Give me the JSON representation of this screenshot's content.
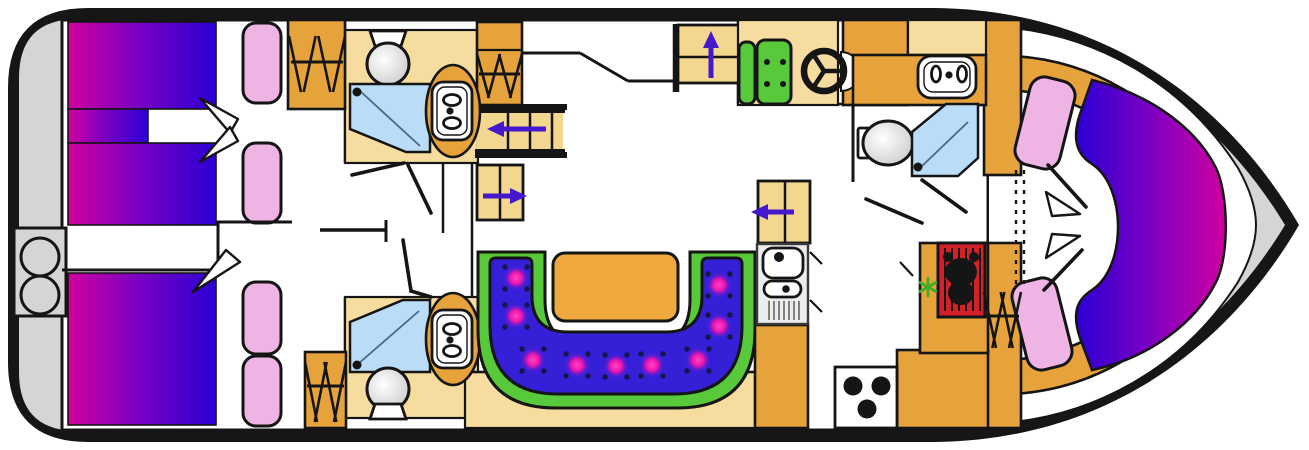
{
  "meta": {
    "title": "Motor yacht lower-deck floor plan",
    "width_px": 1309,
    "height_px": 450,
    "orientation": "stern-left-bow-right"
  },
  "palette": {
    "hull": "#161616",
    "deck": "#d5d5d5",
    "wood": "#e7a33b",
    "wood_light": "#f6dc9e",
    "steps": "#f3d78f",
    "bed_start": "#d0009f",
    "bed_mid": "#7d00c2",
    "bed_end": "#2b00d4",
    "pillow": "#eeb4e4",
    "shower": "#badcf7",
    "sofa_green": "#58c93b",
    "sofa_blue": "#3520d8",
    "sofa_button": "#f016ae",
    "table": "#efa93e",
    "red": "#d3202b",
    "arrow": "#4418cc",
    "snow": "#3fae24"
  },
  "icons": {
    "berth": "berth-gradient-mattress",
    "pillow": "pillow-icon",
    "toilet": "toilet-icon",
    "shower": "shower-tray-icon",
    "washbasin": "washbasin-icon",
    "hanging_locker": "clothes-hangers-icon",
    "reading_light": "reading-light-cone-icon",
    "helm_wheel": "steering-wheel-icon",
    "helm_seat": "helm-seat-icon",
    "galley_sink": "galley-sink-drainer-icon",
    "stove": "three-burner-stove-icon",
    "heater": "heater-grille-icon",
    "freezer": "snowflake-icon",
    "stairs": "companionway-steps-icon",
    "direction_arrow": "purple-direction-arrow-icon",
    "stern_lockers": "twin-gas-bottle-icon",
    "settee": "u-shaped-settee",
    "salon_table": "salon-table",
    "accordion_door": "folding-door-dashes"
  },
  "sofa_buttons": [
    [
      516,
      278
    ],
    [
      516,
      316
    ],
    [
      533,
      360
    ],
    [
      577,
      365
    ],
    [
      616,
      366
    ],
    [
      652,
      365
    ],
    [
      698,
      360
    ],
    [
      719,
      326
    ],
    [
      719,
      285
    ]
  ],
  "stove_burners": [
    [
      853,
      386
    ],
    [
      881,
      386
    ],
    [
      867,
      409
    ]
  ],
  "hanger_racks": [
    {
      "x0": 291,
      "x1": 343,
      "rail_y": 62,
      "top": 36,
      "bottom": 92
    },
    {
      "x0": 479,
      "x1": 520,
      "rail_y": 74,
      "top": 54,
      "bottom": 98
    },
    {
      "x0": 307,
      "x1": 344,
      "rail_y": 386,
      "top": 362,
      "bottom": 422
    },
    {
      "x0": 986,
      "x1": 1019,
      "rail_y": 316,
      "top": 292,
      "bottom": 348
    }
  ],
  "arrows": [
    {
      "name": "companionway-up-arrow",
      "dir": "up",
      "x": 711,
      "from": 78,
      "to": 31
    },
    {
      "name": "aft-stairs-left-arrow",
      "dir": "left",
      "y": 129,
      "from": 546,
      "to": 487
    },
    {
      "name": "aft-steps-right-arrow",
      "dir": "right",
      "y": 196,
      "from": 483,
      "to": 527
    },
    {
      "name": "galley-steps-left-arrow",
      "dir": "left",
      "y": 212,
      "from": 794,
      "to": 751
    }
  ],
  "reading_lights": [
    "200,98 238,119 230,133",
    "200,162 238,141 230,127",
    "193,292 240,262 226,250",
    "1046,192 1080,214 1052,216",
    "1046,258 1080,236 1052,234"
  ]
}
